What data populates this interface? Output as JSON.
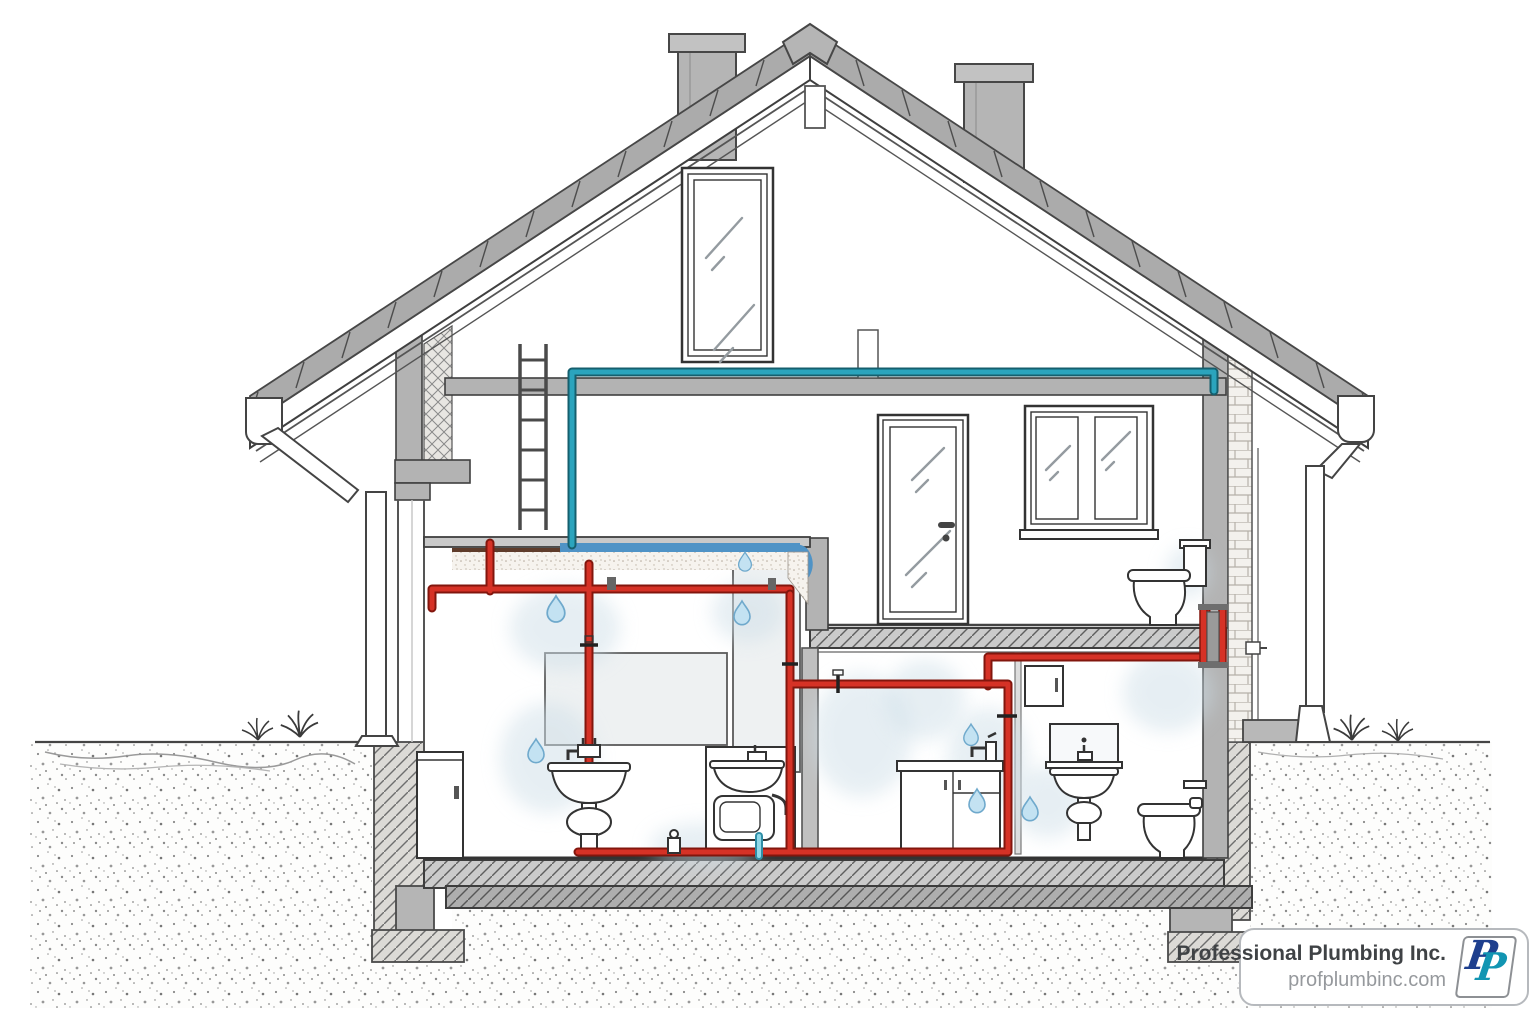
{
  "badge": {
    "company": "Professional Plumbing Inc.",
    "website": "profplumbinc.com",
    "logo_letter_1": "P",
    "logo_letter_2": "P"
  },
  "colors": {
    "hot-pipe": "#d63226",
    "hot-pipe-edge": "#82160d",
    "cold-pipe": "#2ba4bd",
    "cold-pipe-edge": "#155f6e",
    "drain-pipe": "#8fd8e8",
    "membrane-blue": "#4f93c6",
    "droplet-fill": "#c3e2f2",
    "droplet-edge": "#6fa9cc",
    "structure-gray": "#b3b3b3",
    "badge-border": "#b6b9bd",
    "company-text": "#3f4245",
    "website-text": "#96999d",
    "logo-navy": "#1e3f8e",
    "logo-teal": "#1295b2"
  },
  "scene": {
    "type": "house-plumbing-cross-section-diagram",
    "elements": [
      "gable-roof",
      "roof-tiles",
      "chimney-left",
      "chimney-right",
      "ridge-vent",
      "attic-window",
      "gutter-left",
      "gutter-right",
      "downspout-left",
      "downspout-right",
      "attic-floor",
      "ladder",
      "cold-water-line",
      "hot-water-line",
      "shut-off-valves",
      "ceiling-insulation",
      "waterproofing-membrane",
      "interior-door",
      "casement-window",
      "toilet-upper-floor",
      "pedestal-sink",
      "utility-cabinet",
      "utility-sink-unit",
      "kitchen-counter",
      "kitchen-faucet",
      "wall-cabinet",
      "bathroom-mirror",
      "wall-hung-sink",
      "p-trap",
      "toilet-ground-floor",
      "toilet-paper-holder",
      "drain-line",
      "floor-drain",
      "hose-bib",
      "floor-slab",
      "foundation-footings",
      "soil",
      "grass",
      "water-droplets",
      "moisture-stains"
    ]
  }
}
